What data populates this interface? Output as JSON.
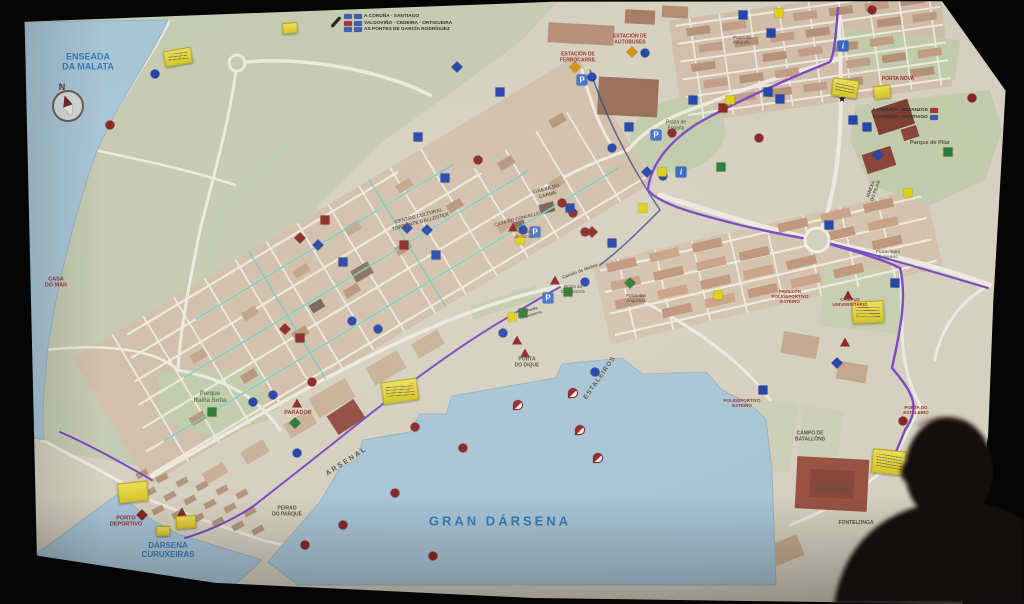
{
  "map": {
    "paper_color": "#d8d2c0",
    "water_color": "#a6c6da",
    "accents": {
      "route_teal": "#6fccb8",
      "route_purple": "#7a44cc",
      "route_navy": "#27408b",
      "marker_blue": "#1a3fb0",
      "marker_red": "#8e1f1c",
      "marker_green": "#1e7c2f",
      "marker_yellow": "#e3d200",
      "marker_orange": "#d98f00",
      "marker_black": "#151515",
      "sticky_yellow": "#e5d42c",
      "badge_blue": "#3a57b5",
      "badge_red": "#a83030"
    },
    "compass": {
      "label": "N",
      "x": 68,
      "y": 106
    },
    "signs": [
      {
        "name": "roadsign-top-center",
        "x": 344,
        "y": 14,
        "align": "left",
        "rows": [
          {
            "badges": [
              "#3a57b5",
              "#3a57b5"
            ],
            "text": "A CORUÑA · SANTIAGO"
          },
          {
            "badges": [
              "#a83030",
              "#3a57b5"
            ],
            "text": "VALDOVIÑO · CEDEIRA · ORTIGUEIRA"
          },
          {
            "badges": [
              "#3a57b5",
              "#3a57b5"
            ],
            "text": "AS PONTES DE GARCÍA RODRÍGUEZ"
          }
        ]
      },
      {
        "name": "roadsign-top-right",
        "x": 872,
        "y": 108,
        "align": "right",
        "rows": [
          {
            "text": "A CORUÑA · BETANZOS",
            "badges": [
              "#a83030"
            ]
          },
          {
            "text": "A CORUÑA · SANTIAGO",
            "badges": [
              "#3a57b5"
            ]
          }
        ]
      }
    ],
    "labels": [
      {
        "text": "ENSEADA\nDA MALATA",
        "x": 88,
        "y": 62,
        "kind": "water",
        "size": 9
      },
      {
        "text": "GRAN DÁRSENA",
        "x": 500,
        "y": 522,
        "kind": "water",
        "size": 13,
        "spacing": 3
      },
      {
        "text": "DÁRSENA\nCURUXEIRAS",
        "x": 168,
        "y": 550,
        "kind": "water",
        "size": 8
      },
      {
        "text": "PORTO\nDEPORTIVO",
        "x": 126,
        "y": 522,
        "kind": "poi",
        "size": 5.5
      },
      {
        "text": "ARSENAL",
        "x": 347,
        "y": 462,
        "kind": "area",
        "size": 7,
        "rot": -33,
        "spacing": 2
      },
      {
        "text": "ESTALEIROS",
        "x": 600,
        "y": 378,
        "kind": "area",
        "size": 6.5,
        "rot": -55,
        "spacing": 1
      },
      {
        "text": "PORTA\nDO DIQUE",
        "x": 527,
        "y": 363,
        "kind": "area",
        "size": 5
      },
      {
        "text": "PEIRAO\nDO PARQUE",
        "x": 287,
        "y": 512,
        "kind": "area",
        "size": 5
      },
      {
        "text": "CASA\nDO MAR",
        "x": 56,
        "y": 283,
        "kind": "poi",
        "size": 5.5
      },
      {
        "text": "Parque\nRaíña Sofía",
        "x": 210,
        "y": 398,
        "kind": "park",
        "size": 6
      },
      {
        "text": "PARADOR",
        "x": 298,
        "y": 413,
        "kind": "poi",
        "size": 5.5
      },
      {
        "text": "CENTRO CULTURAL\nTORRENTE BALLESTER",
        "x": 420,
        "y": 220,
        "kind": "area",
        "size": 5,
        "rot": -15
      },
      {
        "text": "IGREXA DO\nCARME",
        "x": 547,
        "y": 193,
        "kind": "area",
        "size": 5,
        "rot": -15
      },
      {
        "text": "CASA DO CONCELLO",
        "x": 517,
        "y": 219,
        "kind": "area",
        "size": 4.5,
        "rot": -15
      },
      {
        "text": "Praza\nde Armas",
        "x": 524,
        "y": 234,
        "kind": "plaza",
        "size": 4.5
      },
      {
        "text": "Cantón de Molíns",
        "x": 580,
        "y": 271,
        "kind": "area",
        "size": 4.5,
        "rot": -20
      },
      {
        "text": "Praza da\nConstitución",
        "x": 573,
        "y": 289,
        "kind": "plaza",
        "size": 4.5
      },
      {
        "text": "Praza das\nAngustias",
        "x": 636,
        "y": 298,
        "kind": "plaza",
        "size": 4.5
      },
      {
        "text": "Alameda\nde Suances",
        "x": 530,
        "y": 313,
        "kind": "area",
        "size": 4.2,
        "rot": -16
      },
      {
        "text": "Praza de\nEspaña",
        "x": 676,
        "y": 126,
        "kind": "plaza",
        "size": 5
      },
      {
        "text": "ESTACIÓN DE\nAUTOBUSES",
        "x": 630,
        "y": 40,
        "kind": "poi",
        "size": 5
      },
      {
        "text": "ESTACIÓN DE\nFERROCARRIL",
        "x": 578,
        "y": 58,
        "kind": "poi",
        "size": 5
      },
      {
        "text": "Praza do\nInferniño",
        "x": 742,
        "y": 40,
        "kind": "plaza",
        "size": 4.5
      },
      {
        "text": "PORTA NOVA",
        "x": 898,
        "y": 80,
        "kind": "poi",
        "size": 5
      },
      {
        "text": "Parque de Pilar",
        "x": 930,
        "y": 143,
        "kind": "area",
        "size": 5.5
      },
      {
        "text": "IGREXA\nDO PILAR",
        "x": 873,
        "y": 190,
        "kind": "area",
        "size": 4.5,
        "rot": -70
      },
      {
        "text": "PAVILLÓN\nPOLIDEPORTIVO\nESTEIRO",
        "x": 790,
        "y": 297,
        "kind": "poi",
        "size": 4.5
      },
      {
        "text": "POLIDEPORTIVO\nESTEIRO",
        "x": 742,
        "y": 403,
        "kind": "poi",
        "size": 4.5
      },
      {
        "text": "CAMPUS\nUNIVERSITARIO",
        "x": 850,
        "y": 302,
        "kind": "poi",
        "size": 4.5
      },
      {
        "text": "PORTA DO\nESTALEIRO",
        "x": 916,
        "y": 410,
        "kind": "poi",
        "size": 4.5
      },
      {
        "text": "CAMPO DE\nBATALLÓNS",
        "x": 810,
        "y": 437,
        "kind": "area",
        "size": 5
      },
      {
        "text": "CUARTEL\nDE DOLORES",
        "x": 833,
        "y": 488,
        "kind": "area",
        "size": 5
      },
      {
        "text": "FONTELONGA",
        "x": 856,
        "y": 524,
        "kind": "area",
        "size": 5
      },
      {
        "text": "Praza Álvaro\nCunqueiro",
        "x": 888,
        "y": 255,
        "kind": "plaza",
        "size": 4.2
      }
    ],
    "icons": [
      {
        "type": "parking",
        "label": "P",
        "x": 535,
        "y": 232
      },
      {
        "type": "parking",
        "label": "P",
        "x": 548,
        "y": 298
      },
      {
        "type": "parking",
        "label": "P",
        "x": 582,
        "y": 80
      },
      {
        "type": "parking",
        "label": "P",
        "x": 656,
        "y": 135
      },
      {
        "type": "info",
        "label": "i",
        "x": 681,
        "y": 172
      },
      {
        "type": "info",
        "label": "i",
        "x": 843,
        "y": 46
      }
    ],
    "stickies": [
      {
        "x": 178,
        "y": 57,
        "w": 26,
        "h": 14,
        "rot": -10,
        "scribble": true
      },
      {
        "x": 290,
        "y": 28,
        "w": 13,
        "h": 9,
        "rot": -5,
        "scribble": false
      },
      {
        "x": 400,
        "y": 391,
        "w": 34,
        "h": 20,
        "rot": -8,
        "scribble": true
      },
      {
        "x": 133,
        "y": 492,
        "w": 28,
        "h": 18,
        "rot": -6,
        "scribble": false
      },
      {
        "x": 186,
        "y": 522,
        "w": 18,
        "h": 11,
        "rot": -4,
        "scribble": false
      },
      {
        "x": 163,
        "y": 531,
        "w": 12,
        "h": 8,
        "rot": 0,
        "scribble": false
      },
      {
        "x": 845,
        "y": 88,
        "w": 24,
        "h": 16,
        "rot": 8,
        "scribble": true
      },
      {
        "x": 882,
        "y": 92,
        "w": 15,
        "h": 11,
        "rot": -6,
        "scribble": false
      },
      {
        "x": 868,
        "y": 312,
        "w": 30,
        "h": 20,
        "rot": -3,
        "scribble": true
      },
      {
        "x": 889,
        "y": 462,
        "w": 32,
        "h": 22,
        "rot": 6,
        "scribble": true
      }
    ],
    "markers": [
      {
        "x": 155,
        "y": 74,
        "shape": "circle",
        "color": "blue"
      },
      {
        "x": 110,
        "y": 125,
        "shape": "circle",
        "color": "red"
      },
      {
        "x": 457,
        "y": 67,
        "shape": "diamond",
        "color": "blue"
      },
      {
        "x": 500,
        "y": 92,
        "shape": "square",
        "color": "blue"
      },
      {
        "x": 418,
        "y": 137,
        "shape": "square",
        "color": "blue"
      },
      {
        "x": 445,
        "y": 178,
        "shape": "square",
        "color": "blue"
      },
      {
        "x": 478,
        "y": 160,
        "shape": "circle",
        "color": "red"
      },
      {
        "x": 325,
        "y": 220,
        "shape": "square",
        "color": "red"
      },
      {
        "x": 300,
        "y": 238,
        "shape": "diamond",
        "color": "red"
      },
      {
        "x": 318,
        "y": 245,
        "shape": "diamond",
        "color": "blue"
      },
      {
        "x": 407,
        "y": 228,
        "shape": "diamond",
        "color": "blue"
      },
      {
        "x": 427,
        "y": 230,
        "shape": "diamond",
        "color": "blue"
      },
      {
        "x": 343,
        "y": 262,
        "shape": "square",
        "color": "blue"
      },
      {
        "x": 436,
        "y": 255,
        "shape": "square",
        "color": "blue"
      },
      {
        "x": 404,
        "y": 245,
        "shape": "square",
        "color": "red"
      },
      {
        "x": 300,
        "y": 338,
        "shape": "square",
        "color": "red"
      },
      {
        "x": 285,
        "y": 329,
        "shape": "diamond",
        "color": "red"
      },
      {
        "x": 352,
        "y": 321,
        "shape": "circle",
        "color": "blue"
      },
      {
        "x": 378,
        "y": 329,
        "shape": "circle",
        "color": "blue"
      },
      {
        "x": 523,
        "y": 230,
        "shape": "circle",
        "color": "blue"
      },
      {
        "x": 513,
        "y": 227,
        "shape": "triangle",
        "color": "red"
      },
      {
        "x": 520,
        "y": 240,
        "shape": "square",
        "color": "yellow"
      },
      {
        "x": 562,
        "y": 203,
        "shape": "circle",
        "color": "red"
      },
      {
        "x": 573,
        "y": 213,
        "shape": "circle",
        "color": "red"
      },
      {
        "x": 585,
        "y": 232,
        "shape": "circle",
        "color": "red"
      },
      {
        "x": 570,
        "y": 208,
        "shape": "square",
        "color": "blue"
      },
      {
        "x": 592,
        "y": 232,
        "shape": "diamond",
        "color": "red"
      },
      {
        "x": 612,
        "y": 243,
        "shape": "square",
        "color": "blue"
      },
      {
        "x": 629,
        "y": 127,
        "shape": "square",
        "color": "blue"
      },
      {
        "x": 612,
        "y": 148,
        "shape": "circle",
        "color": "blue"
      },
      {
        "x": 645,
        "y": 53,
        "shape": "circle",
        "color": "blue"
      },
      {
        "x": 592,
        "y": 77,
        "shape": "circle",
        "color": "blue"
      },
      {
        "x": 632,
        "y": 52,
        "shape": "diamond",
        "color": "orange"
      },
      {
        "x": 575,
        "y": 67,
        "shape": "diamond",
        "color": "orange"
      },
      {
        "x": 672,
        "y": 133,
        "shape": "circle",
        "color": "red"
      },
      {
        "x": 759,
        "y": 138,
        "shape": "circle",
        "color": "red"
      },
      {
        "x": 663,
        "y": 176,
        "shape": "circle",
        "color": "blue"
      },
      {
        "x": 647,
        "y": 172,
        "shape": "diamond",
        "color": "blue"
      },
      {
        "x": 662,
        "y": 172,
        "shape": "square",
        "color": "yellow"
      },
      {
        "x": 643,
        "y": 208,
        "shape": "square",
        "color": "yellow"
      },
      {
        "x": 721,
        "y": 167,
        "shape": "square",
        "color": "green"
      },
      {
        "x": 555,
        "y": 280,
        "shape": "triangle",
        "color": "red"
      },
      {
        "x": 585,
        "y": 282,
        "shape": "circle",
        "color": "blue"
      },
      {
        "x": 568,
        "y": 292,
        "shape": "square",
        "color": "green"
      },
      {
        "x": 630,
        "y": 283,
        "shape": "diamond",
        "color": "green"
      },
      {
        "x": 523,
        "y": 313,
        "shape": "square",
        "color": "green"
      },
      {
        "x": 512,
        "y": 317,
        "shape": "square",
        "color": "yellow"
      },
      {
        "x": 503,
        "y": 333,
        "shape": "circle",
        "color": "blue"
      },
      {
        "x": 517,
        "y": 340,
        "shape": "triangle",
        "color": "red"
      },
      {
        "x": 525,
        "y": 353,
        "shape": "triangle",
        "color": "red"
      },
      {
        "x": 595,
        "y": 372,
        "shape": "circle",
        "color": "blue"
      },
      {
        "x": 212,
        "y": 412,
        "shape": "square",
        "color": "green"
      },
      {
        "x": 253,
        "y": 402,
        "shape": "circle",
        "color": "blue"
      },
      {
        "x": 273,
        "y": 395,
        "shape": "circle",
        "color": "blue"
      },
      {
        "x": 312,
        "y": 382,
        "shape": "circle",
        "color": "red"
      },
      {
        "x": 297,
        "y": 403,
        "shape": "triangle",
        "color": "red"
      },
      {
        "x": 295,
        "y": 423,
        "shape": "diamond",
        "color": "green"
      },
      {
        "x": 297,
        "y": 453,
        "shape": "circle",
        "color": "blue"
      },
      {
        "x": 182,
        "y": 512,
        "shape": "triangle",
        "color": "red"
      },
      {
        "x": 142,
        "y": 515,
        "shape": "diamond",
        "color": "red"
      },
      {
        "x": 305,
        "y": 545,
        "shape": "circle",
        "color": "red"
      },
      {
        "x": 343,
        "y": 525,
        "shape": "circle",
        "color": "red"
      },
      {
        "x": 415,
        "y": 427,
        "shape": "circle",
        "color": "red"
      },
      {
        "x": 463,
        "y": 448,
        "shape": "circle",
        "color": "red"
      },
      {
        "x": 395,
        "y": 493,
        "shape": "circle",
        "color": "red"
      },
      {
        "x": 433,
        "y": 556,
        "shape": "circle",
        "color": "red"
      },
      {
        "x": 518,
        "y": 405,
        "shape": "sail",
        "color": "red"
      },
      {
        "x": 573,
        "y": 393,
        "shape": "sail",
        "color": "red"
      },
      {
        "x": 580,
        "y": 430,
        "shape": "sail",
        "color": "red"
      },
      {
        "x": 598,
        "y": 458,
        "shape": "sail",
        "color": "red"
      },
      {
        "x": 693,
        "y": 100,
        "shape": "square",
        "color": "blue"
      },
      {
        "x": 723,
        "y": 108,
        "shape": "square",
        "color": "red"
      },
      {
        "x": 730,
        "y": 100,
        "shape": "square",
        "color": "yellow"
      },
      {
        "x": 743,
        "y": 15,
        "shape": "square",
        "color": "blue"
      },
      {
        "x": 771,
        "y": 33,
        "shape": "square",
        "color": "blue"
      },
      {
        "x": 779,
        "y": 13,
        "shape": "square",
        "color": "yellow"
      },
      {
        "x": 768,
        "y": 92,
        "shape": "square",
        "color": "blue"
      },
      {
        "x": 780,
        "y": 99,
        "shape": "square",
        "color": "blue"
      },
      {
        "x": 842,
        "y": 100,
        "shape": "star",
        "color": "black"
      },
      {
        "x": 872,
        "y": 10,
        "shape": "circle",
        "color": "red"
      },
      {
        "x": 853,
        "y": 120,
        "shape": "square",
        "color": "blue"
      },
      {
        "x": 867,
        "y": 127,
        "shape": "square",
        "color": "blue"
      },
      {
        "x": 878,
        "y": 155,
        "shape": "diamond",
        "color": "blue"
      },
      {
        "x": 948,
        "y": 152,
        "shape": "square",
        "color": "green"
      },
      {
        "x": 908,
        "y": 193,
        "shape": "square",
        "color": "yellow"
      },
      {
        "x": 972,
        "y": 98,
        "shape": "circle",
        "color": "red"
      },
      {
        "x": 829,
        "y": 225,
        "shape": "square",
        "color": "blue"
      },
      {
        "x": 895,
        "y": 283,
        "shape": "square",
        "color": "blue"
      },
      {
        "x": 848,
        "y": 295,
        "shape": "triangle",
        "color": "red"
      },
      {
        "x": 845,
        "y": 342,
        "shape": "triangle",
        "color": "red"
      },
      {
        "x": 837,
        "y": 363,
        "shape": "diamond",
        "color": "blue"
      },
      {
        "x": 718,
        "y": 295,
        "shape": "square",
        "color": "yellow"
      },
      {
        "x": 763,
        "y": 390,
        "shape": "square",
        "color": "blue"
      },
      {
        "x": 903,
        "y": 421,
        "shape": "circle",
        "color": "red"
      },
      {
        "x": 336,
        "y": 22,
        "shape": "pen",
        "color": "black"
      }
    ]
  }
}
